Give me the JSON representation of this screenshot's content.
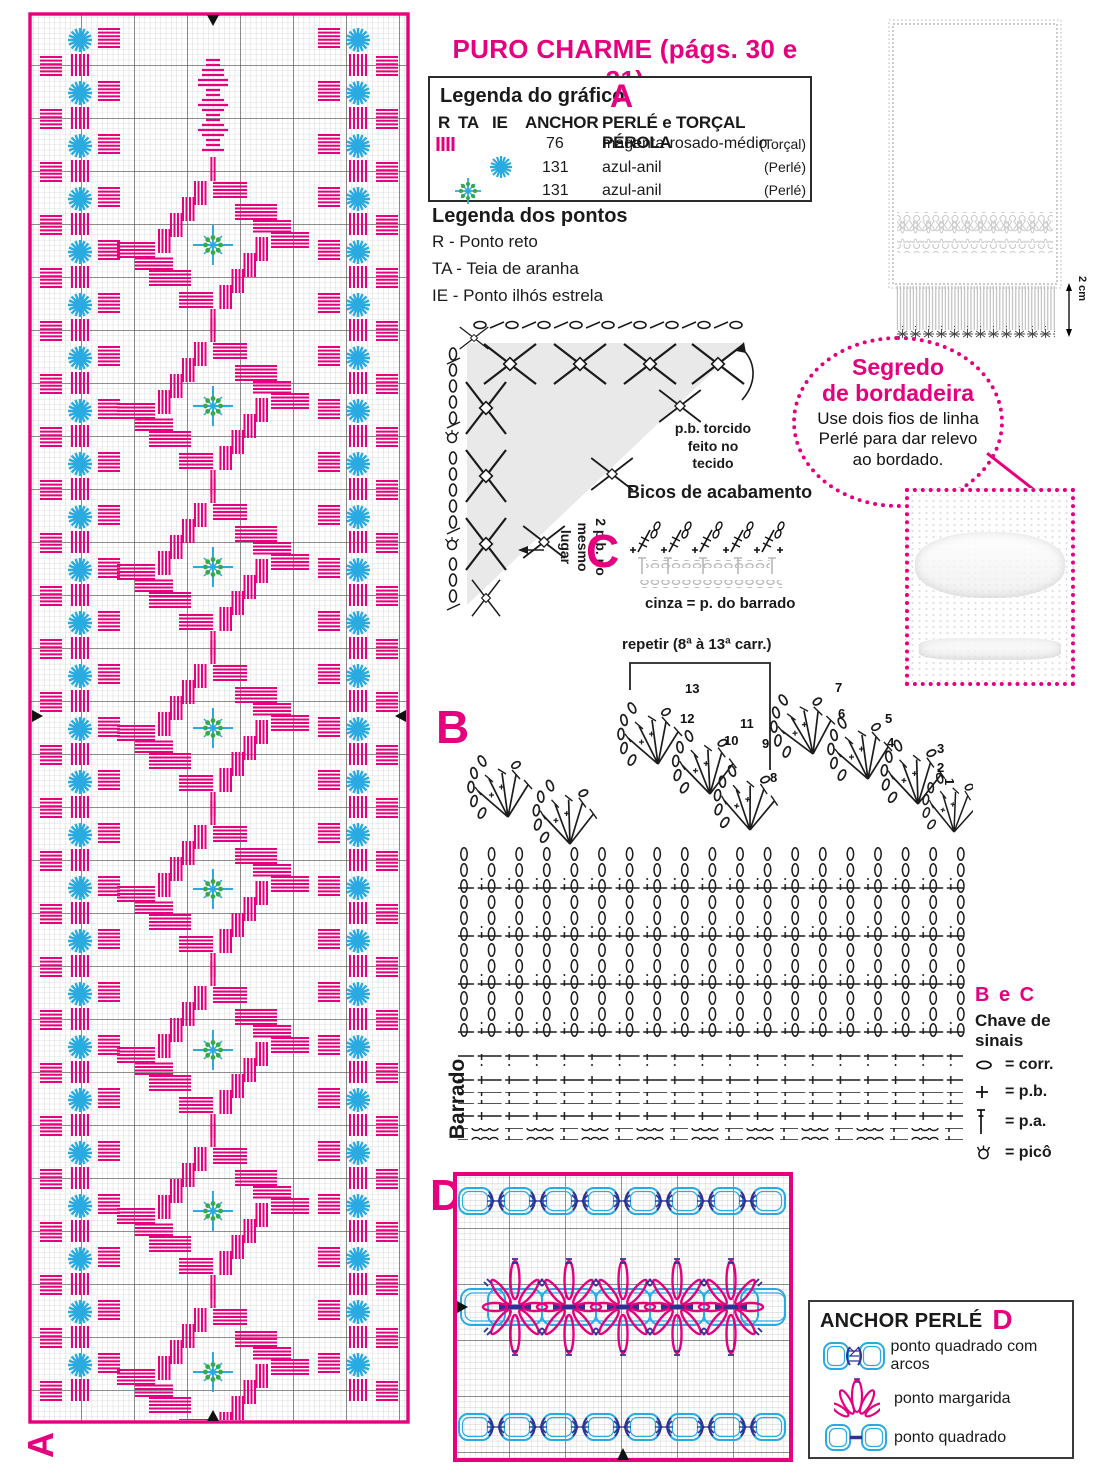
{
  "page": {
    "title": "PURO CHARME (págs. 30 e 31)"
  },
  "colors": {
    "magenta": "#E5007D",
    "cyan": "#29ABE2",
    "green": "#35A94C",
    "dark_blue": "#2E3192",
    "grid_fine": "#bfbfbf",
    "grid_bold": "#4a4a4a",
    "gray_fill": "#e9e9e9"
  },
  "chart_a": {
    "corner_label": "A"
  },
  "legend_grafico": {
    "title": "Legenda do gráfico",
    "badge": "A",
    "col_r": "R",
    "col_ta": "TA",
    "col_ie": "IE",
    "col_anchor": "ANCHOR",
    "col_thread": "PERLÉ e TORÇAL PÉROLA",
    "rows": [
      {
        "symbol": "straight-stitch-bars",
        "anchor": "76",
        "name": "magenta-rosado-médio",
        "thread": "(Torçal)"
      },
      {
        "symbol": "eyelet-starburst",
        "anchor": "131",
        "name": "azul-anil",
        "thread": "(Perlé)"
      },
      {
        "symbol": "spider-web-star",
        "anchor": "131",
        "name": "azul-anil",
        "thread": "(Perlé)"
      }
    ]
  },
  "legend_pontos": {
    "title": "Legenda dos pontos",
    "items": [
      "R - Ponto reto",
      "TA - Teia de aranha",
      "IE - Ponto ilhós estrela"
    ]
  },
  "corner": {
    "badge": "C",
    "note_pb": "p.b. torcido\nfeito no\ntecido",
    "note_2pb": "2 p.b. no\nmesmo\nlugar",
    "bicos_title": "Bicos de acabamento",
    "cinza_note": "cinza = p. do barrado"
  },
  "segredo": {
    "title": "Segredo\nde bordadeira",
    "body": "Use dois fios de linha\nPerlé para dar relevo\nao bordado."
  },
  "towel": {
    "fringe_label": "2 cm"
  },
  "chart_b": {
    "badge": "B",
    "side_label": "Barrado",
    "repeat_label": "repetir (8ª à 13ª carr.)",
    "row_numbers": [
      "1",
      "2",
      "3",
      "4",
      "5",
      "6",
      "7",
      "8",
      "9",
      "10",
      "11",
      "12",
      "13"
    ]
  },
  "chave": {
    "badge": "B e C",
    "title": "Chave de sinais",
    "items": [
      {
        "symbol": "chain-icon",
        "label": "= corr."
      },
      {
        "symbol": "plus-icon",
        "label": "= p.b."
      },
      {
        "symbol": "treble-icon",
        "label": "= p.a."
      },
      {
        "symbol": "picot-icon",
        "label": "= picô"
      }
    ]
  },
  "chart_d": {
    "badge": "D"
  },
  "anchor_perle": {
    "title": "ANCHOR PERLÉ",
    "badge": "D",
    "items": [
      {
        "symbol": "square-with-arcs-icon",
        "label": "ponto quadrado com arcos"
      },
      {
        "symbol": "daisy-stitch-icon",
        "label": "ponto margarida"
      },
      {
        "symbol": "square-stitch-icon",
        "label": "ponto quadrado"
      }
    ]
  },
  "icons": {
    "straight-stitch-bars": "||||",
    "eyelet-starburst": "✳",
    "spider-web-star": "✳",
    "chain-icon": "oval-outline",
    "plus-icon": "+",
    "treble-icon": "T-bar",
    "picot-icon": "crowned-circle",
    "marker-down": "▼",
    "marker-up": "▲",
    "marker-left": "◀",
    "marker-right": "▶"
  }
}
